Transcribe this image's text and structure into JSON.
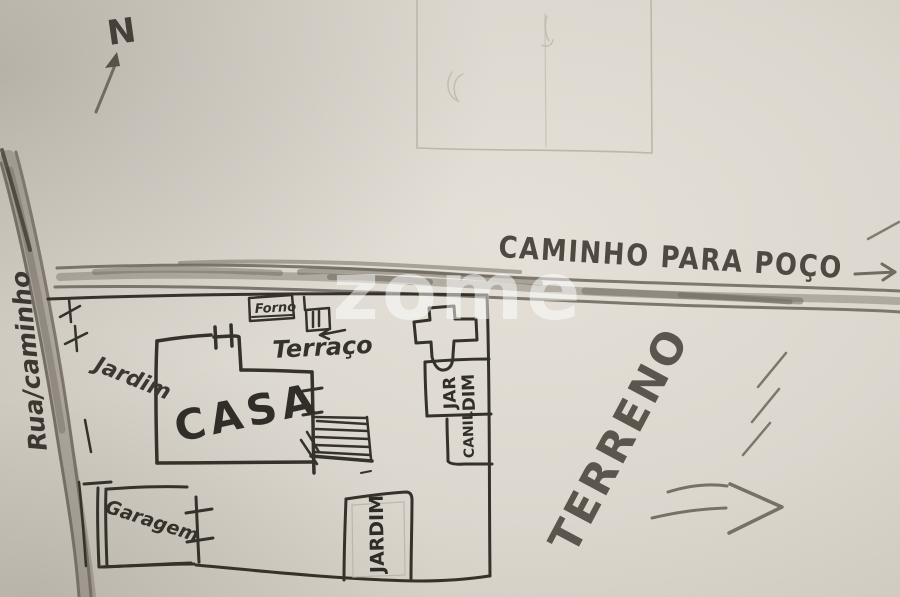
{
  "compass": {
    "label": "N"
  },
  "roads": {
    "caminho_para_poco": "CAMINHO PARA POÇO",
    "rua_caminho": "Rua/caminho"
  },
  "labels": {
    "casa": "CASA",
    "jardim_left": "Jardim",
    "terraco": "Terraço",
    "forno": "Forno",
    "garagem": "Garagem",
    "jardim_right_line1": "JAR",
    "jardim_right_line2": "DIM",
    "canil": "CANIL",
    "jardim_bottom": "JARDIM",
    "terreno": "TERRENO"
  },
  "watermark": {
    "text": "zome"
  },
  "colors": {
    "paper": "#ddd8cf",
    "pen": "#35312b",
    "pencil": "#6b655b",
    "watermark": "rgba(255,255,255,0.5)"
  }
}
